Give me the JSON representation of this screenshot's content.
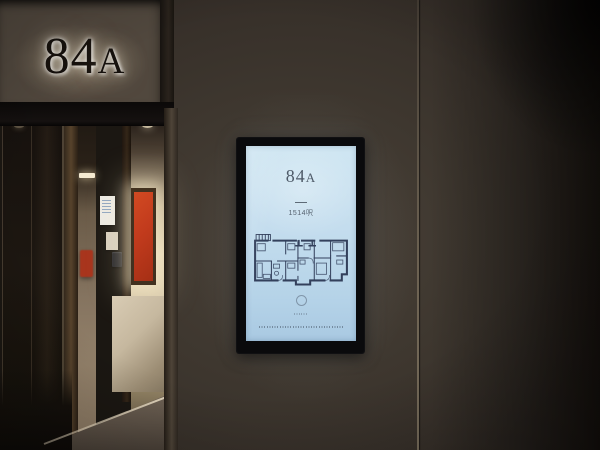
{
  "door_sign": {
    "number": "84",
    "letter": "A"
  },
  "kiosk_screen": {
    "unit_number": "84",
    "unit_letter": "A",
    "divider": "—",
    "area": "1514呎",
    "colors": {
      "screen_bg_top": "#cfe6f2",
      "screen_bg_bottom": "#a9c9e2",
      "plan_lines": "#33405c",
      "title_text": "#4e5a68",
      "bezel": "#0a0a0c"
    }
  },
  "environment": {
    "wall_color": "#3b342e",
    "entry_panel_color": "#51483e",
    "artwork_red": "#c23b1d",
    "interior_glow": "#e3d6b8"
  }
}
